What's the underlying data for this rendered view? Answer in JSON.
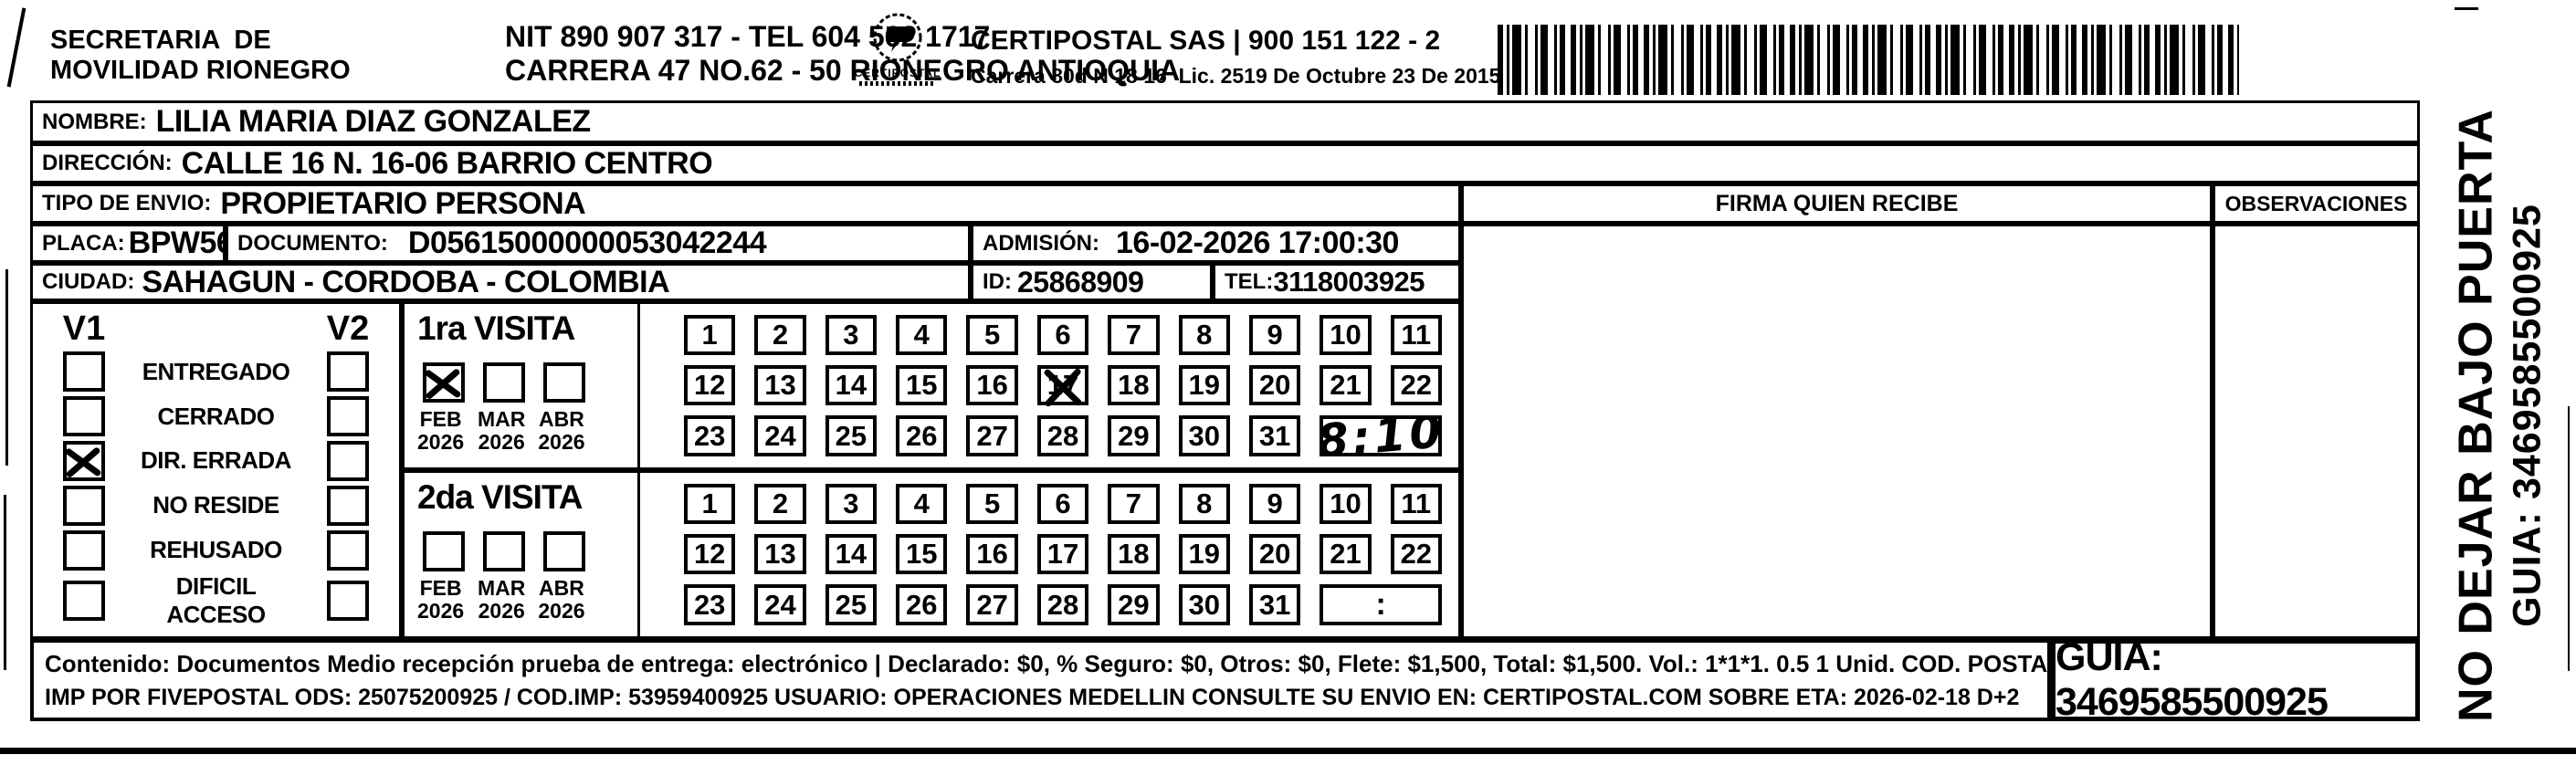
{
  "header": {
    "sender": [
      "SECRETARIA  DE",
      "MOVILIDAD RIONEGRO"
    ],
    "nit_lines": [
      "NIT 890 907 317 - TEL 604 562 1717",
      "CARRERA 47 NO.62 - 50 RIONEGRO ANTIOQUIA"
    ],
    "logo_name": "CERTIPOSTAL",
    "company_lines": [
      "CERTIPOSTAL SAS | 900 151 122 - 2",
      "Carrera 80d N 18 16  Lic. 2519 De Octubre 23 De 2015"
    ]
  },
  "fields": {
    "nombre_label": "NOMBRE:",
    "nombre_value": "LILIA MARIA DIAZ GONZALEZ",
    "direccion_label": "DIRECCIÓN:",
    "direccion_value": "CALLE 16 N. 16-06 BARRIO CENTRO",
    "tipo_label": "TIPO DE ENVIO:",
    "tipo_value": "PROPIETARIO PERSONA",
    "placa_label": "PLACA:",
    "placa_value": "BPW560",
    "documento_label": "DOCUMENTO:",
    "documento_value": "D05615000000053042244",
    "admision_label": "ADMISIÓN:",
    "admision_value": "16-02-2026 17:00:30",
    "ciudad_label": "CIUDAD:",
    "ciudad_value": "SAHAGUN - CORDOBA - COLOMBIA",
    "id_label": "ID:",
    "id_value": "25868909",
    "tel_label": "TEL:",
    "tel_value": "3118003925"
  },
  "table_headers": {
    "firma": "FIRMA QUIEN RECIBE",
    "observaciones": "OBSERVACIONES"
  },
  "status_panel": {
    "col1": "V1",
    "col2": "V2",
    "options": [
      {
        "label": "ENTREGADO",
        "v1": false,
        "v2": false
      },
      {
        "label": "CERRADO",
        "v1": false,
        "v2": false
      },
      {
        "label": "DIR. ERRADA",
        "v1": true,
        "v2": false
      },
      {
        "label": "NO RESIDE",
        "v1": false,
        "v2": false
      },
      {
        "label": "REHUSADO",
        "v1": false,
        "v2": false
      },
      {
        "label": "DIFICIL ACCESO",
        "v1": false,
        "v2": false
      }
    ]
  },
  "visits": [
    {
      "title": "1ra VISITA",
      "months": [
        {
          "month": "FEB",
          "year": "2026",
          "checked": true
        },
        {
          "month": "MAR",
          "year": "2026",
          "checked": false
        },
        {
          "month": "ABR",
          "year": "2026",
          "checked": false
        }
      ],
      "days": [
        1,
        2,
        3,
        4,
        5,
        6,
        7,
        8,
        9,
        10,
        11,
        12,
        13,
        14,
        15,
        16,
        17,
        18,
        19,
        20,
        21,
        22,
        23,
        24,
        25,
        26,
        27,
        28,
        29,
        30,
        31
      ],
      "crossed_days": [
        17
      ],
      "time": "8:10",
      "time_handwritten": true
    },
    {
      "title": "2da VISITA",
      "months": [
        {
          "month": "FEB",
          "year": "2026",
          "checked": false
        },
        {
          "month": "MAR",
          "year": "2026",
          "checked": false
        },
        {
          "month": "ABR",
          "year": "2026",
          "checked": false
        }
      ],
      "days": [
        1,
        2,
        3,
        4,
        5,
        6,
        7,
        8,
        9,
        10,
        11,
        12,
        13,
        14,
        15,
        16,
        17,
        18,
        19,
        20,
        21,
        22,
        23,
        24,
        25,
        26,
        27,
        28,
        29,
        30,
        31
      ],
      "crossed_days": [],
      "time": ":",
      "time_handwritten": false
    }
  ],
  "footer": {
    "line1": "Contenido: Documentos Medio recepción prueba de entrega: electrónico | Declarado: $0, % Seguro: $0, Otros: $0, Flete: $1,500, Total: $1,500. Vol.: 1*1*1. 0.5  1 Unid. COD. POSTAL: 232540",
    "line2": "IMP POR FIVEPOSTAL ODS: 25075200925 / COD.IMP: 53959400925 USUARIO: OPERACIONES MEDELLIN CONSULTE SU ENVIO EN: CERTIPOSTAL.COM SOBRE ETA: 2026-02-18 D+2",
    "guia_box": "GUIA: 3469585500925"
  },
  "sidebar": {
    "warning": "NO DEJAR BAJO PUERTA",
    "guia": "GUIA: 3469585500925"
  }
}
